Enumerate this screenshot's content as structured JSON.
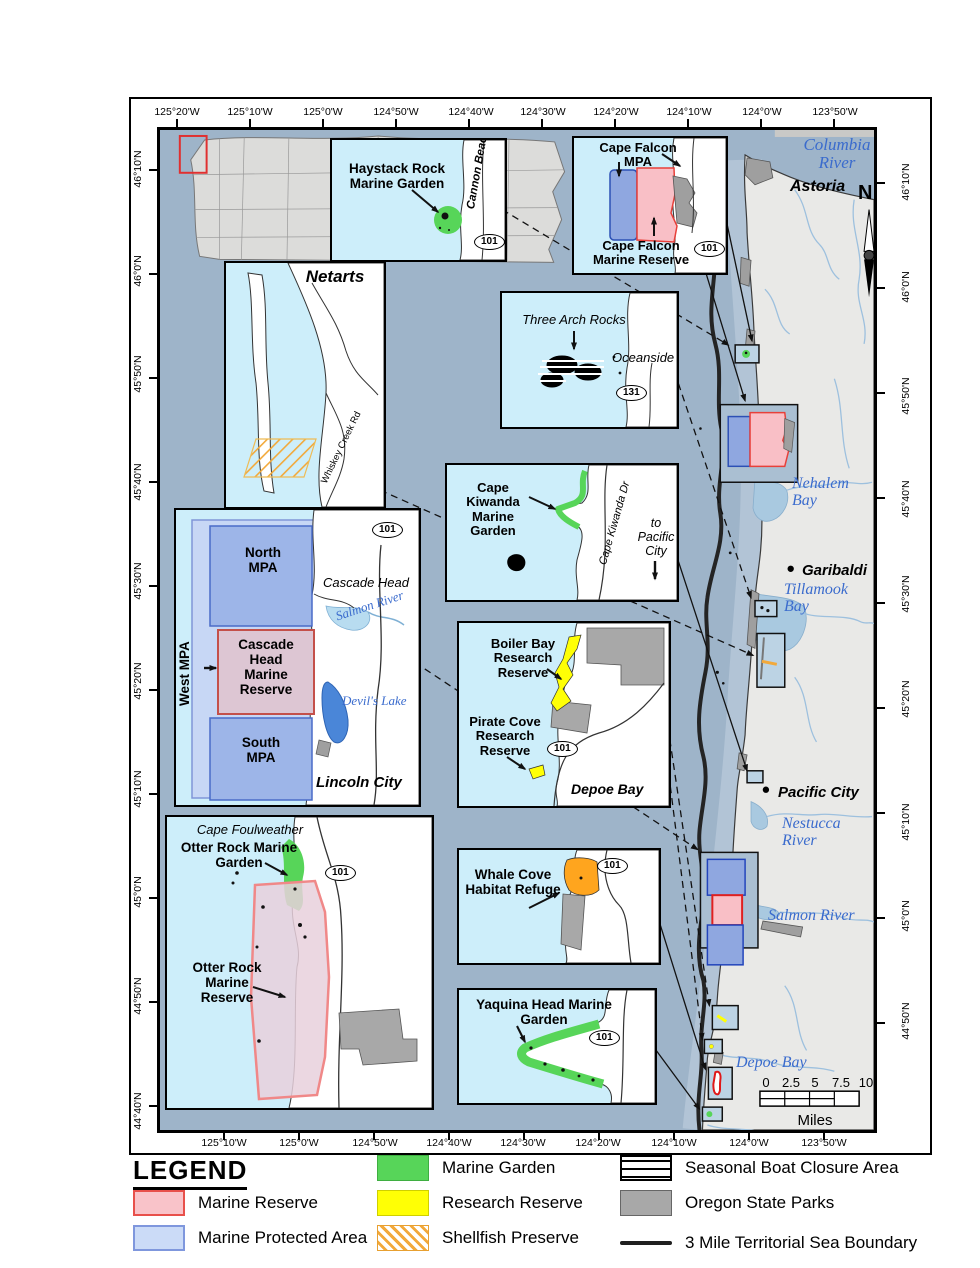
{
  "legend": {
    "title": "LEGEND",
    "items": [
      {
        "label": "Marine Reserve"
      },
      {
        "label": "Marine Protected Area"
      },
      {
        "label": "Marine Garden"
      },
      {
        "label": "Research Reserve"
      },
      {
        "label": "Shellfish Preserve"
      },
      {
        "label": "Seasonal Boat Closure Area"
      },
      {
        "label": "Oregon State Parks"
      },
      {
        "label": "3 Mile Territorial Sea Boundary"
      }
    ]
  },
  "graticule": {
    "top": [
      "125°20'W",
      "125°10'W",
      "125°0'W",
      "124°50'W",
      "124°40'W",
      "124°30'W",
      "124°20'W",
      "124°10'W",
      "124°0'W",
      "123°50'W"
    ],
    "bottom": [
      "125°10'W",
      "125°0'W",
      "124°50'W",
      "124°40'W",
      "124°30'W",
      "124°20'W",
      "124°10'W",
      "124°0'W",
      "123°50'W"
    ],
    "left": [
      "46°10'N",
      "46°0'N",
      "45°50'N",
      "45°40'N",
      "45°30'N",
      "45°20'N",
      "45°10'N",
      "45°0'N",
      "44°50'N",
      "44°40'N"
    ],
    "right": [
      "46°10'N",
      "46°0'N",
      "45°50'N",
      "45°40'N",
      "45°30'N",
      "45°20'N",
      "45°10'N",
      "45°0'N",
      "44°50'N"
    ]
  },
  "map": {
    "north_label": "N",
    "scale_ticks": [
      "0",
      "2.5",
      "5",
      "7.5",
      "10"
    ],
    "scale_unit": "Miles",
    "places": {
      "astoria": "Astoria",
      "garibaldi": "Garibaldi",
      "pacific_city": "Pacific City"
    },
    "waters": {
      "columbia": "Columbia River",
      "nehalem": "Nehalem Bay",
      "tillamook": "Tillamook Bay",
      "nestucca": "Nestucca River",
      "salmon": "Salmon River",
      "depoe": "Depoe Bay"
    }
  },
  "insets": {
    "haystack": {
      "label": "Haystack Rock Marine Garden",
      "coast_road": "Cannon Beach",
      "route": "101"
    },
    "cape_falcon": {
      "mpa": "Cape Falcon MPA",
      "reserve": "Cape Falcon Marine Reserve",
      "route": "101"
    },
    "netarts": {
      "title": "Netarts",
      "road": "Whiskey Creek Rd"
    },
    "three_arch": {
      "label": "Three Arch Rocks",
      "place": "Oceanside",
      "route": "131"
    },
    "kiwanda": {
      "label": "Cape Kiwanda Marine Garden",
      "road": "Cape Kiwanda Dr",
      "dest": "to Pacific City"
    },
    "cascade": {
      "north_mpa": "North MPA",
      "west_mpa": "West MPA",
      "reserve": "Cascade Head Marine Reserve",
      "south_mpa": "South MPA",
      "headland": "Cascade Head",
      "river": "Salmon River",
      "lake": "Devil's Lake",
      "city": "Lincoln City",
      "route": "101"
    },
    "boiler": {
      "boiler": "Boiler Bay Research Reserve",
      "pirate": "Pirate Cove Research Reserve",
      "city": "Depoe Bay",
      "route": "101"
    },
    "otter": {
      "cape": "Cape Foulweather",
      "garden": "Otter Rock Marine Garden",
      "reserve": "Otter Rock Marine Reserve",
      "route": "101"
    },
    "whale": {
      "label": "Whale Cove Habitat Refuge",
      "route": "101"
    },
    "yaquina": {
      "label": "Yaquina Head Marine Garden",
      "route": "101"
    }
  },
  "colors": {
    "ocean": "#9eb4c9",
    "inset_water": "#cdeefa",
    "marine_reserve": "#f9c3c9",
    "mpa": "#8fa7e0",
    "marine_garden": "#57d559",
    "research_reserve": "#ffff05",
    "shellfish": "#f2a93b",
    "habitat_refuge": "#ffa51e",
    "parks": "#a8a8a8",
    "boundary": "#1f1f1f"
  }
}
